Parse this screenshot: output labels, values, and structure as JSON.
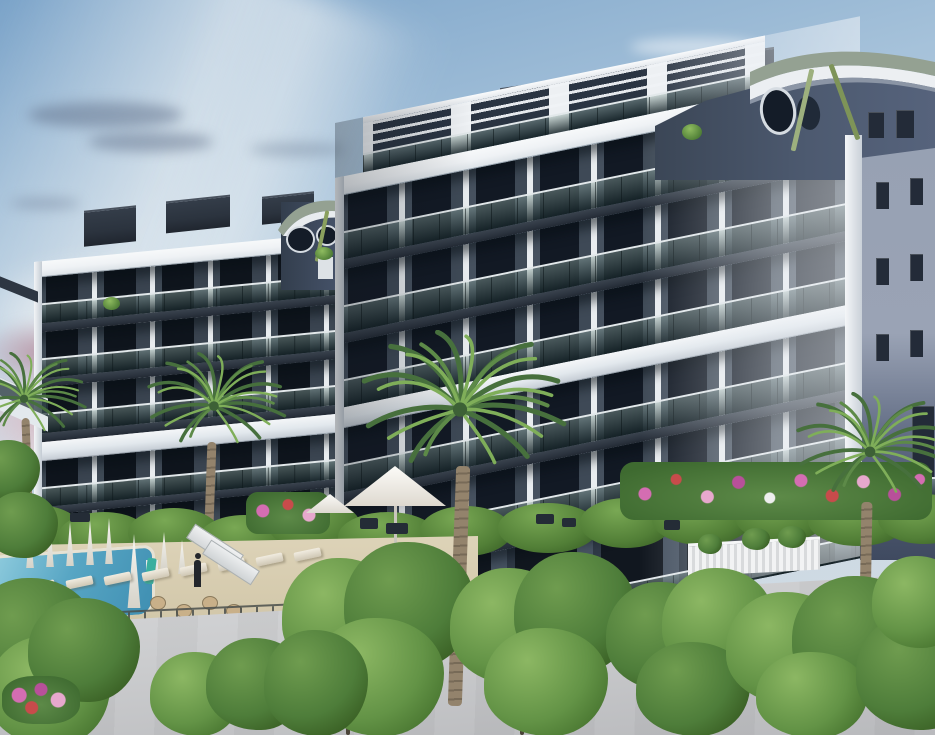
{
  "scene": {
    "title": "Architectural rendering — modern apartment complex at dusk with pool deck and palm trees",
    "time_of_day": "dusk",
    "labels": {
      "sky": "Dusk sky with bright haze and pink sunset clouds at left",
      "building": "Seven-storey apartment block: anthracite facade, white slab bands, smoked-glass balconies, sage curved roof",
      "pool_area": "Pool deck with sun loungers, closed parasols, slide panels and cafe tables",
      "foreground": "Light concrete retaining wall with young green trees"
    }
  },
  "palette": {
    "sky-top": "#79a2c8",
    "sky-mid": "#a6c2da",
    "sky-low": "#ccd8e3",
    "sunset-pink": "#cfa8b4",
    "cloud-dusk": "#7286a4",
    "facade": "#46515f",
    "facade-deep": "#39434f",
    "pier": "#e9edf0",
    "window": "#121924",
    "slab-dark": "#2a323d",
    "band-white": "#eff2f5",
    "glass-light": "#8aa39d",
    "glass-dark": "#22343a",
    "side-wall": "#98a2b4",
    "gable": "#46526a",
    "roof-sage": "#94a192",
    "accent-green": "#8aa05e",
    "metal-dark": "#2b333e",
    "hedge-dark": "#3e6a30",
    "tree-light": "#8cb763",
    "tree-mid": "#639346",
    "tree-dark": "#47742f",
    "deck": "#d7cdb2",
    "pool-light": "#8ecbdd",
    "pool-deep": "#3f8fb2",
    "wall-light": "#d8d9db",
    "wall-shade": "#b9babd",
    "trunk": "#93836c",
    "trunk-ring": "#776a57",
    "fence": "#44494a",
    "flower-pink": "#d46db2",
    "flower-red": "#c84b4b"
  },
  "building": {
    "storeys_visible": 7,
    "wings": [
      {
        "id": "left-wing",
        "bays": 5,
        "white_bands": 2,
        "end_portholes": 2,
        "roof": "flat parapets with sage curved end fin"
      },
      {
        "id": "main-wing",
        "bays": 7,
        "white_bands": 2,
        "rooftop": "white pergola penthouses and dark parapet slabs"
      },
      {
        "id": "corner-tower",
        "roof": "curved sage canopy",
        "portholes": 2,
        "green_struts": 2,
        "side_window_rows": 4
      }
    ],
    "materials": [
      "white concrete bands",
      "anthracite panels",
      "smoked glass balustrades",
      "sage curved roof"
    ]
  },
  "landscape": {
    "palm_trees": 4,
    "foreground_trees": 6,
    "pool": {
      "present": true
    },
    "sun_loungers": 8,
    "closed_parasols": 8,
    "open_parasols": 2,
    "water_slide": true,
    "cafe_tables": 5,
    "people_silhouettes": 1,
    "lampposts": 1,
    "flower_colors": [
      "pink",
      "magenta",
      "red",
      "white"
    ],
    "fences": [
      "dark metal railing",
      "white slat fence"
    ],
    "retaining_walls": 2
  }
}
